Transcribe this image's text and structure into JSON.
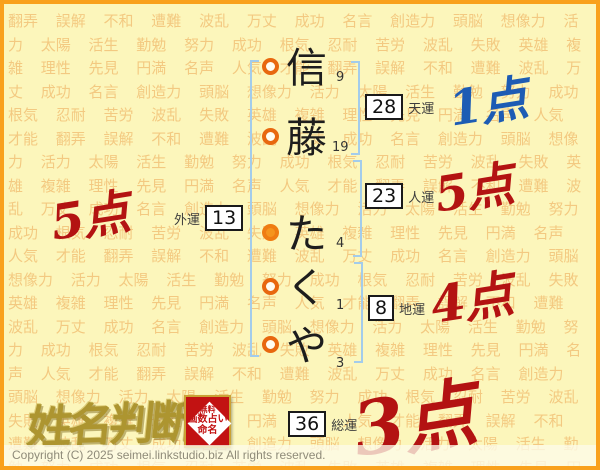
{
  "background": {
    "words": [
      "翻弄",
      "誤解",
      "不和",
      "遭難",
      "波乱",
      "万丈",
      "成功",
      "名言",
      "創造力",
      "頭脳",
      "想像力",
      "活力",
      "太陽",
      "活生",
      "勤勉",
      "努力",
      "成功",
      "根気",
      "忍耐",
      "苦労",
      "波乱",
      "失敗",
      "英雄",
      "複雑",
      "理性",
      "先見",
      "円満",
      "名声",
      "人気",
      "才能"
    ]
  },
  "name": {
    "characters": [
      {
        "char": "信",
        "strokes": "9",
        "marker": "open"
      },
      {
        "char": "藤",
        "strokes": "19",
        "marker": "open"
      },
      {
        "char": "た",
        "strokes": "4",
        "marker": "filled"
      },
      {
        "char": "く",
        "strokes": "1",
        "marker": "open"
      },
      {
        "char": "や",
        "strokes": "3",
        "marker": "open"
      }
    ]
  },
  "fortune": {
    "tenun": {
      "label": "天運",
      "value": "28",
      "score": "1点",
      "score_color": "#1d5cb4"
    },
    "jinun": {
      "label": "人運",
      "value": "23",
      "score": "5点",
      "score_color": "#b31312"
    },
    "chiun": {
      "label": "地運",
      "value": "8",
      "score": "4点",
      "score_color": "#b31312"
    },
    "gaiun": {
      "label": "外運",
      "value": "13",
      "score": "5点",
      "score_color": "#b31312"
    },
    "soun": {
      "label": "総運",
      "value": "36",
      "score": "3点",
      "score_color": "#b31312"
    }
  },
  "branding": {
    "logo_text": "姓名判断",
    "seal_lines": [
      "無料",
      "画数占い",
      "命名"
    ]
  },
  "footer": {
    "copyright": "Copyright (C) 2025 seimei.linkstudio.biz All rights reserved."
  },
  "colors": {
    "border_orange": "#f9a11c",
    "background_yellow": "#fcf6bb",
    "watermark_orange": "#eeaf5e",
    "bracket_blue": "#a3cceb",
    "marker_orange": "#e8680f",
    "score_red": "#b31312",
    "score_blue": "#1d5cb4",
    "seal_red": "#c21212",
    "logo_gold": "#ad9530"
  }
}
